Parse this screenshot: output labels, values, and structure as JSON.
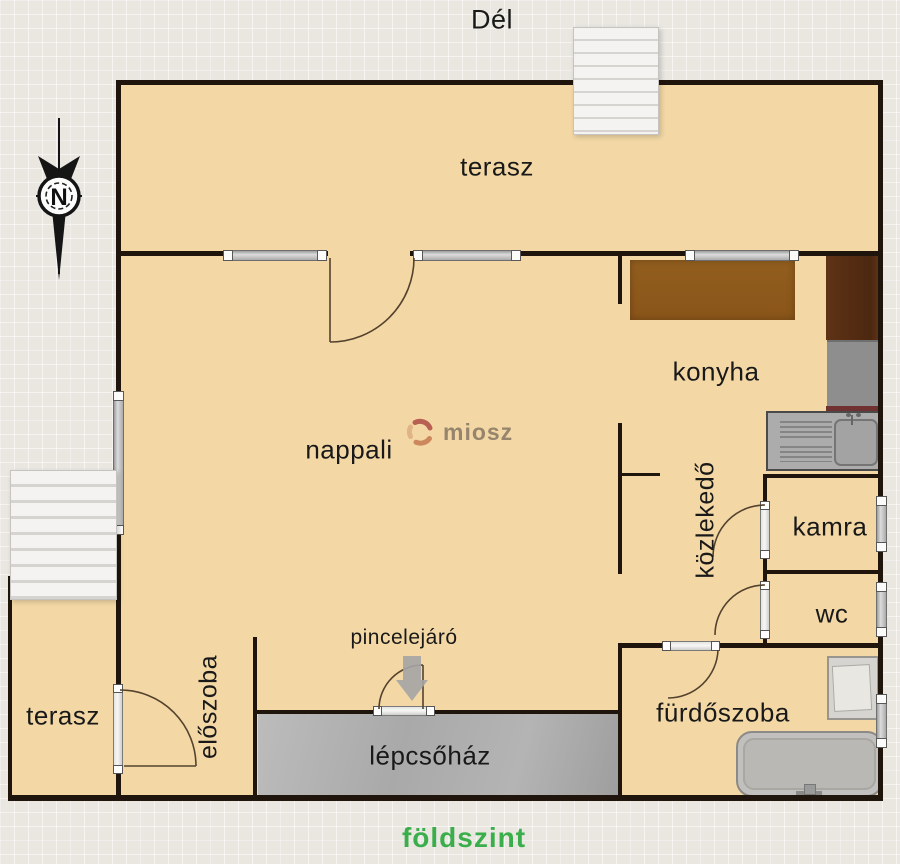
{
  "header": {
    "south_label": "Dél"
  },
  "compass": {
    "north_label": "N"
  },
  "watermark": {
    "text": "miosz"
  },
  "footer": {
    "floor_label": "földszint"
  },
  "rooms": [
    {
      "id": "terasz-top",
      "label": "terasz"
    },
    {
      "id": "nappali",
      "label": "nappali"
    },
    {
      "id": "konyha",
      "label": "konyha"
    },
    {
      "id": "kozlekedo",
      "label": "közlekedő"
    },
    {
      "id": "kamra",
      "label": "kamra"
    },
    {
      "id": "wc",
      "label": "wc"
    },
    {
      "id": "eloszoba",
      "label": "előszoba"
    },
    {
      "id": "terasz-bottom",
      "label": "terasz"
    },
    {
      "id": "lepcsohaz",
      "label": "lépcsőház"
    },
    {
      "id": "furdoszoba",
      "label": "fürdőszoba"
    }
  ],
  "annotations": {
    "basement_entrance": "pincelejáró"
  },
  "colors": {
    "floor": "#f3d8a5",
    "wall": "#20150c",
    "floor_label_green": "#3aae4b",
    "staircase_gray": "#b0b0b0",
    "kitchen_wood": "#8f5b1d",
    "cabinet_wood": "#5a3013",
    "watermark_text": "#8d7c67"
  }
}
